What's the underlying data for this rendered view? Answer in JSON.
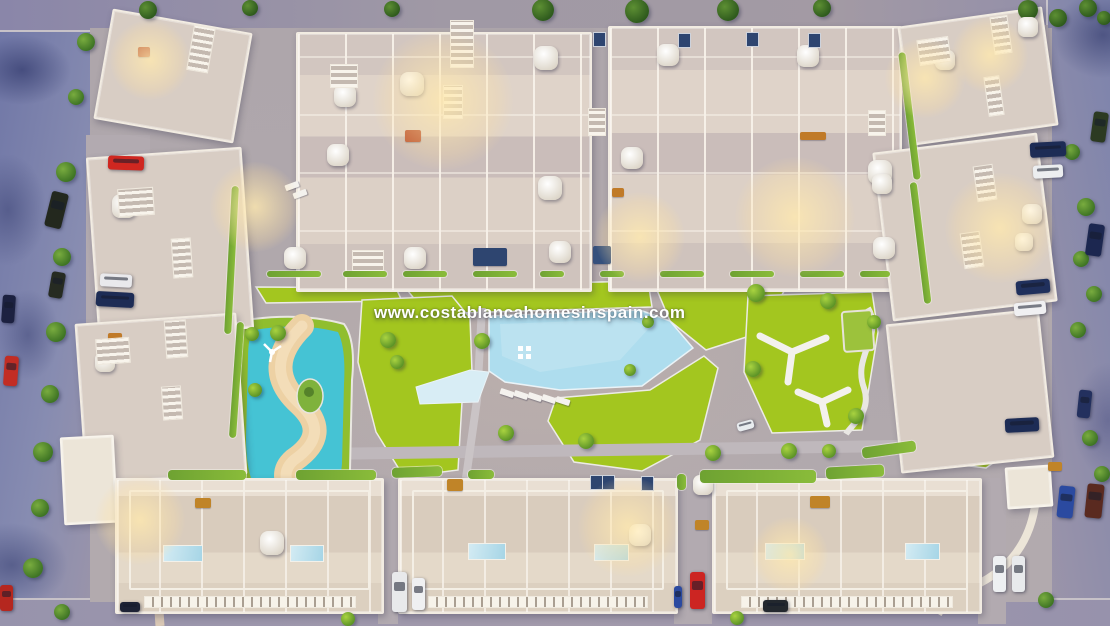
{
  "watermark": {
    "text": "www.costablancahomesinspain.com"
  },
  "scene": {
    "description": "Dusk aerial 3D render of a residential complex: townhouse blocks around a central park with a large pool, a lagoon pool with sand, lawns, and perimeter streets with parked cars",
    "palette": {
      "ground": "#aea6ab",
      "street": "#7d83ac",
      "street_dark": "#3f4677",
      "building": "#d8cdc4",
      "building_trim": "#f2ece2",
      "grass": "#a3c61f",
      "pool_water": "#aeddee",
      "lagoon_water": "#45c3d4",
      "sand": "#edd1a4",
      "tree_dark": "#2e5a1d",
      "glow": "#ffe9af",
      "watermark_text": "#ffffff"
    },
    "trees": [
      [
        148,
        10,
        9,
        0
      ],
      [
        250,
        8,
        8,
        0
      ],
      [
        392,
        9,
        8,
        0
      ],
      [
        543,
        10,
        11,
        0
      ],
      [
        637,
        11,
        12,
        0
      ],
      [
        728,
        10,
        11,
        0
      ],
      [
        822,
        8,
        9,
        0
      ],
      [
        1028,
        10,
        10,
        0
      ],
      [
        1058,
        18,
        9,
        0
      ],
      [
        1088,
        8,
        9,
        0
      ],
      [
        1104,
        18,
        7,
        0
      ],
      [
        86,
        42,
        9,
        1
      ],
      [
        76,
        97,
        8,
        1
      ],
      [
        66,
        172,
        10,
        1
      ],
      [
        62,
        257,
        9,
        1
      ],
      [
        56,
        332,
        10,
        1
      ],
      [
        50,
        394,
        9,
        1
      ],
      [
        43,
        452,
        10,
        1
      ],
      [
        40,
        508,
        9,
        1
      ],
      [
        33,
        568,
        10,
        1
      ],
      [
        1072,
        152,
        8,
        1
      ],
      [
        1086,
        207,
        9,
        1
      ],
      [
        1081,
        259,
        8,
        1
      ],
      [
        1094,
        294,
        8,
        1
      ],
      [
        1078,
        330,
        8,
        1
      ],
      [
        1078,
        392,
        0,
        1
      ],
      [
        1090,
        438,
        8,
        1
      ],
      [
        1102,
        474,
        8,
        1
      ],
      [
        62,
        612,
        8,
        1
      ],
      [
        348,
        619,
        7,
        2
      ],
      [
        737,
        618,
        7,
        2
      ],
      [
        1046,
        600,
        8,
        1
      ],
      [
        278,
        333,
        8,
        2
      ],
      [
        388,
        340,
        8,
        2
      ],
      [
        397,
        362,
        7,
        2
      ],
      [
        482,
        341,
        8,
        2
      ],
      [
        506,
        433,
        8,
        2
      ],
      [
        586,
        441,
        8,
        2
      ],
      [
        756,
        293,
        9,
        2
      ],
      [
        828,
        301,
        8,
        2
      ],
      [
        753,
        369,
        8,
        2
      ],
      [
        856,
        416,
        8,
        2
      ],
      [
        713,
        453,
        8,
        2
      ],
      [
        789,
        451,
        8,
        2
      ],
      [
        829,
        451,
        7,
        2
      ],
      [
        252,
        334,
        7,
        2
      ],
      [
        255,
        390,
        7,
        2
      ],
      [
        874,
        322,
        7,
        2
      ],
      [
        648,
        322,
        6,
        2
      ],
      [
        630,
        370,
        6,
        2
      ]
    ],
    "cars": [
      [
        48,
        192,
        17,
        36,
        14,
        "#23281e"
      ],
      [
        50,
        272,
        14,
        26,
        10,
        "#262b22"
      ],
      [
        2,
        295,
        13,
        28,
        4,
        "#1c2140"
      ],
      [
        4,
        356,
        14,
        30,
        4,
        "#c22d24"
      ],
      [
        108,
        156,
        36,
        14,
        2,
        "#cf2720"
      ],
      [
        100,
        274,
        32,
        13,
        3,
        "#e9e9ec"
      ],
      [
        96,
        292,
        38,
        15,
        3,
        "#1d2c55"
      ],
      [
        1030,
        142,
        36,
        15,
        -3,
        "#1d2c55"
      ],
      [
        1033,
        165,
        30,
        13,
        -3,
        "#eceef0"
      ],
      [
        1016,
        280,
        34,
        14,
        -5,
        "#20305c"
      ],
      [
        1014,
        302,
        32,
        13,
        -5,
        "#f0f0f2"
      ],
      [
        1005,
        418,
        34,
        14,
        -3,
        "#1d2c55"
      ],
      [
        1092,
        112,
        15,
        30,
        8,
        "#2c3a22"
      ],
      [
        1087,
        224,
        16,
        32,
        8,
        "#1c2750"
      ],
      [
        1078,
        390,
        13,
        28,
        6,
        "#23305e"
      ],
      [
        1058,
        486,
        16,
        32,
        6,
        "#2b4aa0"
      ],
      [
        1086,
        484,
        17,
        34,
        6,
        "#5a2a20"
      ],
      [
        392,
        572,
        15,
        40,
        0,
        "#e8e9eb"
      ],
      [
        412,
        578,
        13,
        32,
        0,
        "#eff0f2"
      ],
      [
        690,
        572,
        15,
        37,
        0,
        "#cc2522"
      ],
      [
        674,
        586,
        8,
        22,
        0,
        "#2b4aa0"
      ],
      [
        993,
        556,
        13,
        36,
        0,
        "#eef0f2"
      ],
      [
        1012,
        556,
        13,
        36,
        0,
        "#e8eaec"
      ],
      [
        763,
        600,
        25,
        12,
        0,
        "#23282e"
      ],
      [
        120,
        602,
        20,
        10,
        0,
        "#1d2235"
      ],
      [
        0,
        585,
        13,
        26,
        0,
        "#b5271f"
      ],
      [
        737,
        421,
        17,
        9,
        -15,
        "#e8ecef"
      ]
    ],
    "parasols": [
      [
        345,
        96,
        11
      ],
      [
        412,
        84,
        12
      ],
      [
        546,
        58,
        12
      ],
      [
        338,
        155,
        11
      ],
      [
        550,
        188,
        12
      ],
      [
        295,
        258,
        11
      ],
      [
        415,
        258,
        11
      ],
      [
        560,
        252,
        11
      ],
      [
        668,
        55,
        11
      ],
      [
        808,
        56,
        11
      ],
      [
        632,
        158,
        11
      ],
      [
        880,
        172,
        12
      ],
      [
        884,
        248,
        11
      ],
      [
        1028,
        27,
        10
      ],
      [
        1032,
        214,
        10
      ],
      [
        1024,
        242,
        9
      ],
      [
        882,
        184,
        10
      ],
      [
        124,
        206,
        12
      ],
      [
        105,
        362,
        10
      ],
      [
        272,
        543,
        12
      ],
      [
        640,
        535,
        11
      ],
      [
        703,
        485,
        10
      ],
      [
        945,
        60,
        10
      ]
    ],
    "sunbeds": [
      [
        500,
        390,
        18
      ],
      [
        514,
        392,
        18
      ],
      [
        528,
        394,
        18
      ],
      [
        542,
        396,
        18
      ],
      [
        556,
        398,
        18
      ],
      [
        285,
        183,
        -20
      ],
      [
        293,
        191,
        -20
      ]
    ],
    "roof_pools": [
      [
        163,
        545,
        38,
        15
      ],
      [
        290,
        545,
        32,
        15
      ],
      [
        468,
        543,
        36,
        15
      ],
      [
        594,
        544,
        33,
        15
      ],
      [
        765,
        543,
        38,
        15
      ],
      [
        905,
        543,
        33,
        15
      ]
    ],
    "roof_items": [
      [
        405,
        130,
        16,
        12,
        "#b84a28"
      ],
      [
        138,
        47,
        12,
        10,
        "#b04426"
      ],
      [
        800,
        132,
        26,
        8,
        "#c07a28"
      ],
      [
        447,
        479,
        16,
        12,
        "#c08428"
      ],
      [
        195,
        498,
        16,
        10,
        "#c08428"
      ],
      [
        810,
        496,
        20,
        12,
        "#c08428"
      ],
      [
        695,
        520,
        14,
        10,
        "#c08428"
      ],
      [
        1048,
        462,
        14,
        9,
        "#c08428"
      ],
      [
        108,
        333,
        14,
        9,
        "#c07a28"
      ],
      [
        612,
        188,
        12,
        9,
        "#c07a28"
      ],
      [
        473,
        248,
        34,
        18,
        "#2e4570"
      ],
      [
        593,
        246,
        18,
        18,
        "#35507c"
      ]
    ],
    "panels": [
      [
        593,
        32
      ],
      [
        678,
        33
      ],
      [
        746,
        32
      ],
      [
        808,
        33
      ],
      [
        590,
        475
      ],
      [
        602,
        475
      ],
      [
        641,
        476
      ]
    ],
    "stripes": [
      [
        190,
        26,
        20,
        44,
        10
      ],
      [
        172,
        238,
        18,
        38,
        -4
      ],
      [
        165,
        320,
        20,
        36,
        -4
      ],
      [
        162,
        386,
        18,
        32,
        -4
      ],
      [
        450,
        20,
        22,
        46,
        0
      ],
      [
        443,
        85,
        18,
        32,
        0
      ],
      [
        588,
        108,
        16,
        26,
        0
      ],
      [
        868,
        110,
        16,
        24,
        0
      ],
      [
        992,
        16,
        16,
        36,
        -8
      ],
      [
        986,
        76,
        14,
        38,
        -8
      ],
      [
        975,
        165,
        18,
        34,
        -8
      ],
      [
        962,
        232,
        18,
        34,
        -8
      ],
      [
        118,
        188,
        34,
        26,
        -4
      ],
      [
        96,
        338,
        32,
        24,
        -4
      ],
      [
        330,
        64,
        26,
        22,
        0
      ],
      [
        352,
        250,
        30,
        22,
        0
      ],
      [
        918,
        38,
        30,
        24,
        -8
      ]
    ],
    "hedges": [
      [
        228,
        186,
        7,
        148,
        3
      ],
      [
        233,
        322,
        7,
        116,
        4
      ],
      [
        906,
        52,
        7,
        128,
        -7
      ],
      [
        917,
        182,
        7,
        122,
        -7
      ],
      [
        267,
        271,
        54,
        6,
        0
      ],
      [
        343,
        271,
        44,
        6,
        0
      ],
      [
        403,
        271,
        44,
        6,
        0
      ],
      [
        473,
        271,
        44,
        6,
        0
      ],
      [
        540,
        271,
        24,
        6,
        0
      ],
      [
        600,
        271,
        24,
        6,
        0
      ],
      [
        660,
        271,
        44,
        6,
        0
      ],
      [
        730,
        271,
        44,
        6,
        0
      ],
      [
        800,
        271,
        44,
        6,
        0
      ],
      [
        860,
        271,
        30,
        6,
        0
      ],
      [
        168,
        470,
        78,
        10,
        0
      ],
      [
        296,
        470,
        80,
        10,
        0
      ],
      [
        392,
        467,
        50,
        10,
        -2
      ],
      [
        468,
        470,
        26,
        9,
        0
      ],
      [
        677,
        474,
        9,
        16,
        0
      ],
      [
        700,
        470,
        116,
        13,
        0
      ],
      [
        826,
        466,
        58,
        12,
        -3
      ],
      [
        862,
        444,
        54,
        11,
        -8
      ]
    ],
    "glows": [
      [
        443,
        100,
        70
      ],
      [
        255,
        207,
        45
      ],
      [
        795,
        217,
        60
      ],
      [
        640,
        237,
        45
      ],
      [
        1000,
        228,
        55
      ],
      [
        925,
        78,
        40
      ],
      [
        150,
        60,
        40
      ],
      [
        140,
        520,
        45
      ],
      [
        628,
        527,
        50
      ],
      [
        790,
        555,
        38
      ],
      [
        990,
        55,
        38
      ]
    ]
  }
}
